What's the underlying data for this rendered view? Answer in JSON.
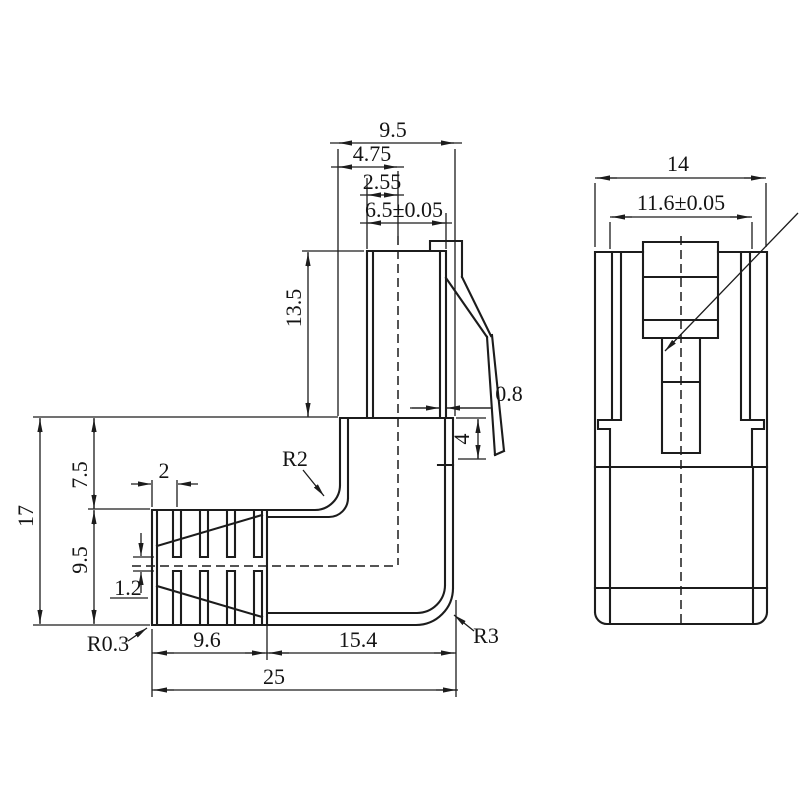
{
  "drawing": {
    "type": "engineering-drawing",
    "description": "Right-angle modular plug connector, two orthographic views with dimensions",
    "colors": {
      "line": "#1c1c1c",
      "background": "#ffffff"
    },
    "side_view": {
      "labels": {
        "top_width": "9.5",
        "half_width": "4.75",
        "center_to_edge": "2.55",
        "plug_width": "6.5±0.05",
        "plug_height": "13.5",
        "latch_thickness": "0.8",
        "latch_drop": "4",
        "overall_height": "17",
        "upper_height": "7.5",
        "boot_height": "9.5",
        "rib_pitch": "2",
        "rib_gap": "1.2",
        "radius_boot": "R0.3",
        "radius_inner": "R2",
        "radius_outer": "R3",
        "boot_length": "9.6",
        "body_length": "15.4",
        "overall_length": "25"
      }
    },
    "front_view": {
      "labels": {
        "overall_width": "14",
        "opening_width": "11.6±0.05"
      }
    }
  }
}
